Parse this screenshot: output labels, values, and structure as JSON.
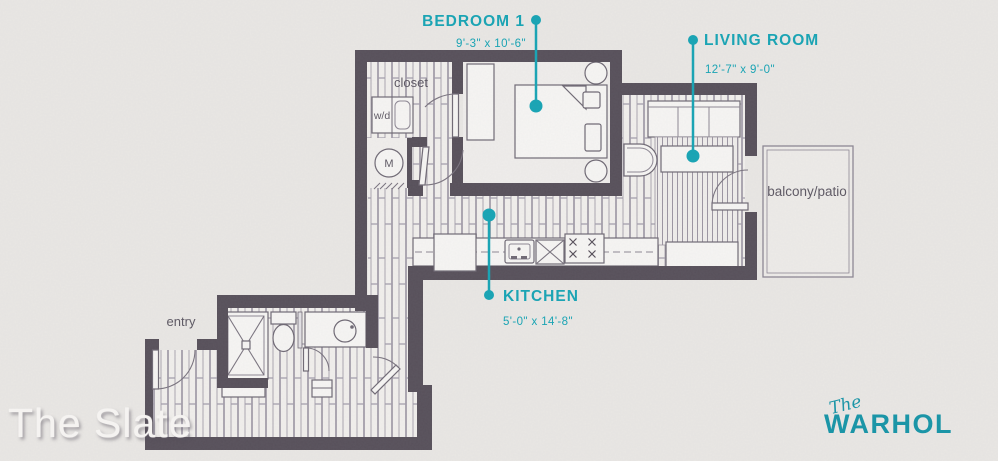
{
  "rooms": {
    "bedroom": {
      "label": "BEDROOM 1",
      "dimensions": "9'-3\" x 10'-6\""
    },
    "living_room": {
      "label": "LIVING ROOM",
      "dimensions": "12'-7\" x 9'-0\""
    },
    "kitchen": {
      "label": "KITCHEN",
      "dimensions": "5'-0\" x 14'-8\""
    }
  },
  "annotations": {
    "closet": "closet",
    "washer_dryer": "w/d",
    "mechanical": "M",
    "entry": "entry",
    "balcony": "balcony/patio"
  },
  "branding": {
    "floor_plan_name": "The Slate",
    "building_prefix": "The",
    "building_name": "WARHOL"
  },
  "colors": {
    "accent_teal": "#16a4b4",
    "wall": "#57505a",
    "background": "#e9e7e4"
  }
}
